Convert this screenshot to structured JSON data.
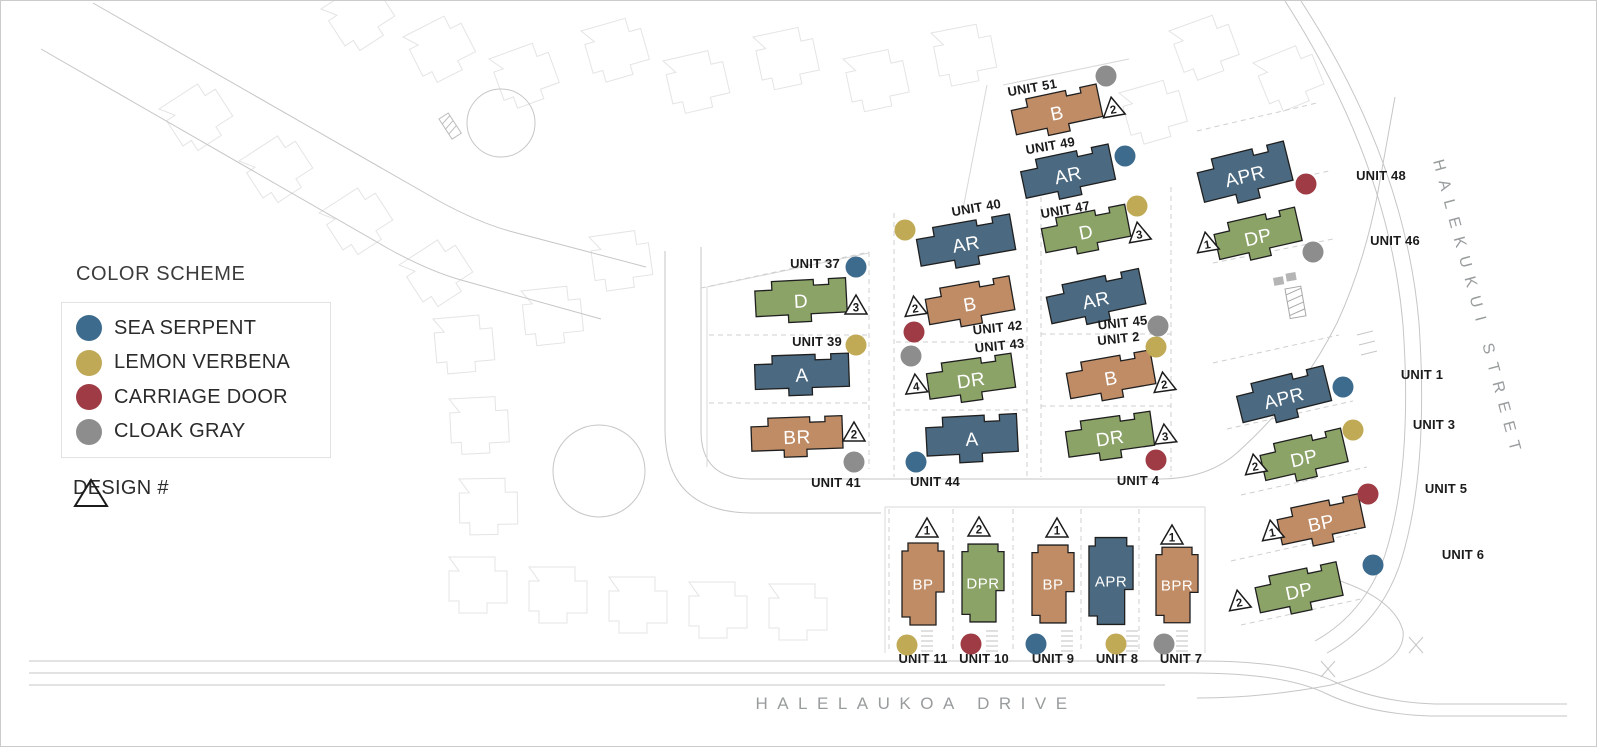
{
  "legend": {
    "title": "COLOR SCHEME",
    "items": [
      {
        "name": "SEA SERPENT",
        "color": "#3d6b8d"
      },
      {
        "name": "LEMON VERBENA",
        "color": "#bfa856"
      },
      {
        "name": "CARRIAGE DOOR",
        "color": "#9e3b44"
      },
      {
        "name": "CLOAK GRAY",
        "color": "#8d8d8d"
      }
    ],
    "design_label": "DESIGN #"
  },
  "streets": {
    "right": "HALEKUKUI STREET",
    "bottom": "HALELAUKOA DRIVE"
  },
  "building_colors": {
    "tan": "#c08c66",
    "blue": "#4b6a81",
    "green": "#8ca368"
  },
  "dot_colors": {
    "blue": "#3d6b8d",
    "yellow": "#c1aa55",
    "red": "#9e3b44",
    "gray": "#8d8d8d"
  },
  "units": [
    {
      "unit": "UNIT 51",
      "model": "B",
      "scheme": "tan",
      "design": "2",
      "dot": "gray"
    },
    {
      "unit": "UNIT 49",
      "model": "AR",
      "scheme": "blue",
      "design": null,
      "dot": "blue"
    },
    {
      "unit": "UNIT 40",
      "model": "AR",
      "scheme": "blue",
      "design": null,
      "dot": "yellow"
    },
    {
      "unit": "UNIT 47",
      "model": "D",
      "scheme": "green",
      "design": "3",
      "dot": "yellow"
    },
    {
      "unit": "UNIT 42",
      "model": "B",
      "scheme": "tan",
      "design": "2",
      "dot": "red"
    },
    {
      "unit": "UNIT 45",
      "model": "AR",
      "scheme": "blue",
      "design": null,
      "dot": "gray"
    },
    {
      "unit": "UNIT 43",
      "model": "DR",
      "scheme": "green",
      "design": "4",
      "dot": "gray"
    },
    {
      "unit": "UNIT 2",
      "model": "B",
      "scheme": "tan",
      "design": "2",
      "dot": "yellow"
    },
    {
      "unit": "UNIT 44",
      "model": "A",
      "scheme": "blue",
      "design": null,
      "dot": "blue"
    },
    {
      "unit": "UNIT 4",
      "model": "DR",
      "scheme": "green",
      "design": "3",
      "dot": "red"
    },
    {
      "unit": "UNIT 37",
      "model": "D",
      "scheme": "green",
      "design": "3",
      "dot": "blue"
    },
    {
      "unit": "UNIT 39",
      "model": "A",
      "scheme": "blue",
      "design": null,
      "dot": "yellow"
    },
    {
      "unit": "UNIT 41",
      "model": "BR",
      "scheme": "tan",
      "design": "2",
      "dot": "gray"
    },
    {
      "unit": "UNIT 48",
      "model": "APR",
      "scheme": "blue",
      "design": null,
      "dot": "red"
    },
    {
      "unit": "UNIT 46",
      "model": "DP",
      "scheme": "green",
      "design": "1",
      "dot": "gray"
    },
    {
      "unit": "UNIT 1",
      "model": "APR",
      "scheme": "blue",
      "design": null,
      "dot": "blue"
    },
    {
      "unit": "UNIT 3",
      "model": "DP",
      "scheme": "green",
      "design": "2",
      "dot": "yellow"
    },
    {
      "unit": "UNIT 5",
      "model": "BP",
      "scheme": "tan",
      "design": "1",
      "dot": "red"
    },
    {
      "unit": "UNIT 6",
      "model": "DP",
      "scheme": "green",
      "design": "2",
      "dot": "blue"
    },
    {
      "unit": "UNIT 11",
      "model": "BP",
      "scheme": "tan",
      "design": "1",
      "dot": "yellow"
    },
    {
      "unit": "UNIT 10",
      "model": "DPR",
      "scheme": "green",
      "design": "2",
      "dot": "red"
    },
    {
      "unit": "UNIT 9",
      "model": "BP",
      "scheme": "tan",
      "design": "1",
      "dot": "blue"
    },
    {
      "unit": "UNIT 8",
      "model": "APR",
      "scheme": "blue",
      "design": null,
      "dot": "yellow"
    },
    {
      "unit": "UNIT 7",
      "model": "BPR",
      "scheme": "tan",
      "design": "1",
      "dot": "gray"
    }
  ]
}
